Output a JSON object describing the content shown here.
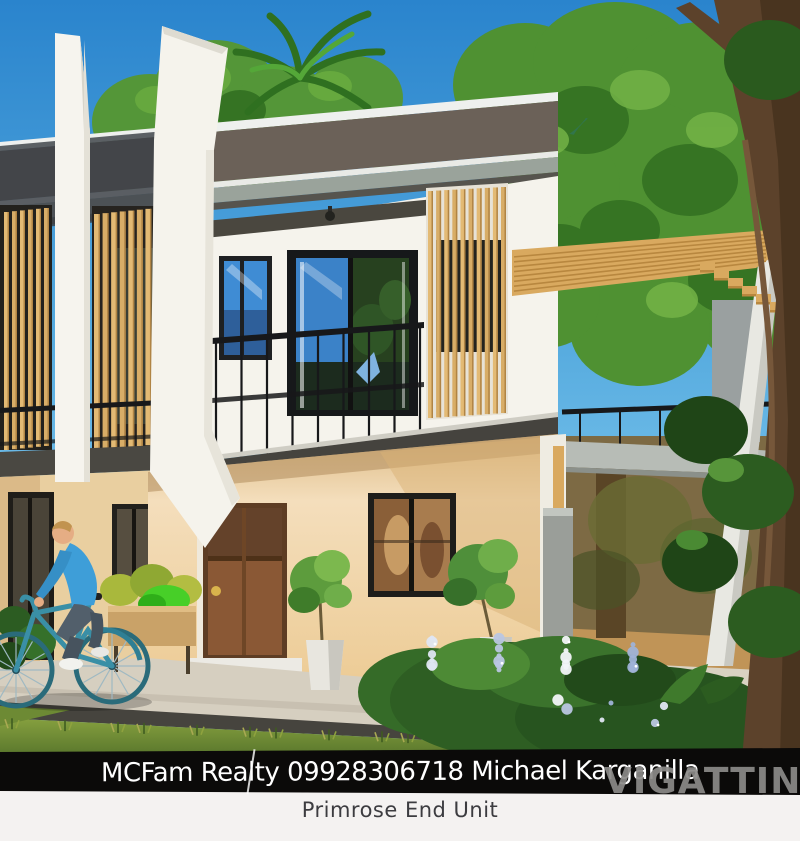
{
  "captions": {
    "agency_line": "MCFam Realty 09928306718 Michael Karganilla",
    "unit_name": "Primrose End Unit",
    "watermark": "VIGATTIN"
  },
  "palette": {
    "sky_top": "#2a84cd",
    "sky_bottom": "#7cc6ee",
    "foliage_dark": "#2e6b1f",
    "foliage_mid": "#549638",
    "foliage_light": "#68ab3f",
    "tree_trunk": "#5c422b",
    "roof_fascia_dark": "#6b6158",
    "roof_band_gray": "#9aa39b",
    "wall_white": "#f5f3ec",
    "wall_cream": "#f4debc",
    "wall_cream_shade": "#e5c38b",
    "wood_slat": "#d8ad67",
    "door_brown": "#8a5835",
    "railing_black": "#17181a",
    "slab_dark": "#45433e",
    "bike_teal": "#3a8fa6",
    "shirt_blue": "#3e9ed8",
    "grass_green": "#6b8733",
    "walkway": "#d6cfc0",
    "asphalt": "#46443e",
    "caption_bg": "#0b0a09",
    "caption_text": "#ffffff",
    "footer_bg": "#f4f2f1",
    "footer_text": "#3c3c40",
    "watermark_gray": "#8b8a88"
  }
}
